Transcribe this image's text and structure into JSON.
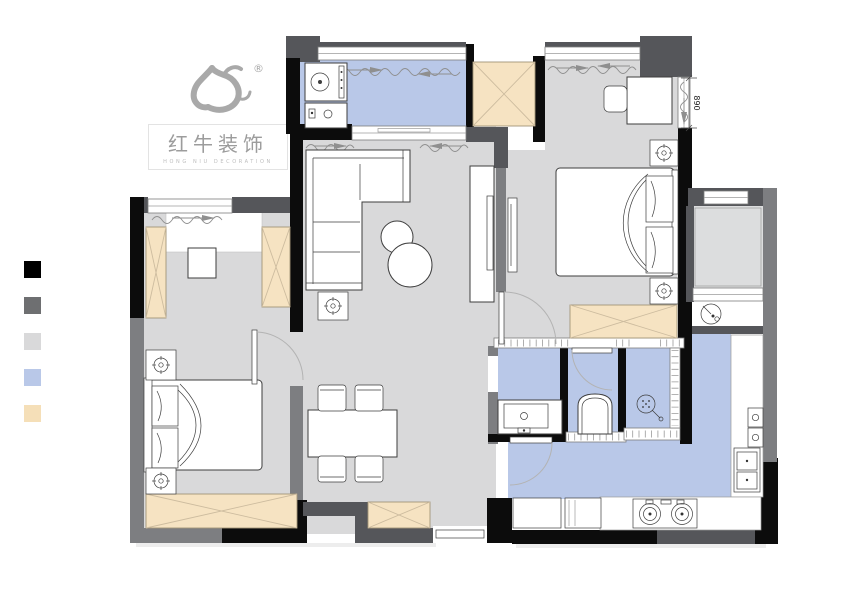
{
  "logo": {
    "brand_cn": "红牛装饰",
    "brand_en": "HONG NIU DECORATION",
    "registered_mark": "®"
  },
  "legend": {
    "items": [
      {
        "name": "black",
        "color": "#000000"
      },
      {
        "name": "dark-gray",
        "color": "#6e6f71"
      },
      {
        "name": "light-gray",
        "color": "#d9d9da"
      },
      {
        "name": "light-blue",
        "color": "#b9c8e8"
      },
      {
        "name": "beige",
        "color": "#f5dfb8"
      }
    ]
  },
  "floorplan": {
    "dimension_label": "890"
  },
  "palette": {
    "wall_black": "#0c0c0c",
    "wall_dark_gray": "#55565a",
    "wall_mid_gray": "#7d7e81",
    "floor_gray": "#d9d9da",
    "floor_gray_light": "#dcddde",
    "floor_blue": "#b9c8e8",
    "cabinet_beige": "#f6e3c2",
    "cabinet_beige_line": "#cdbc9f",
    "cabinet_beige_stroke": "#a29478",
    "furniture_stroke": "#3e3e3e",
    "logo_gray": "#a5a5a5"
  }
}
